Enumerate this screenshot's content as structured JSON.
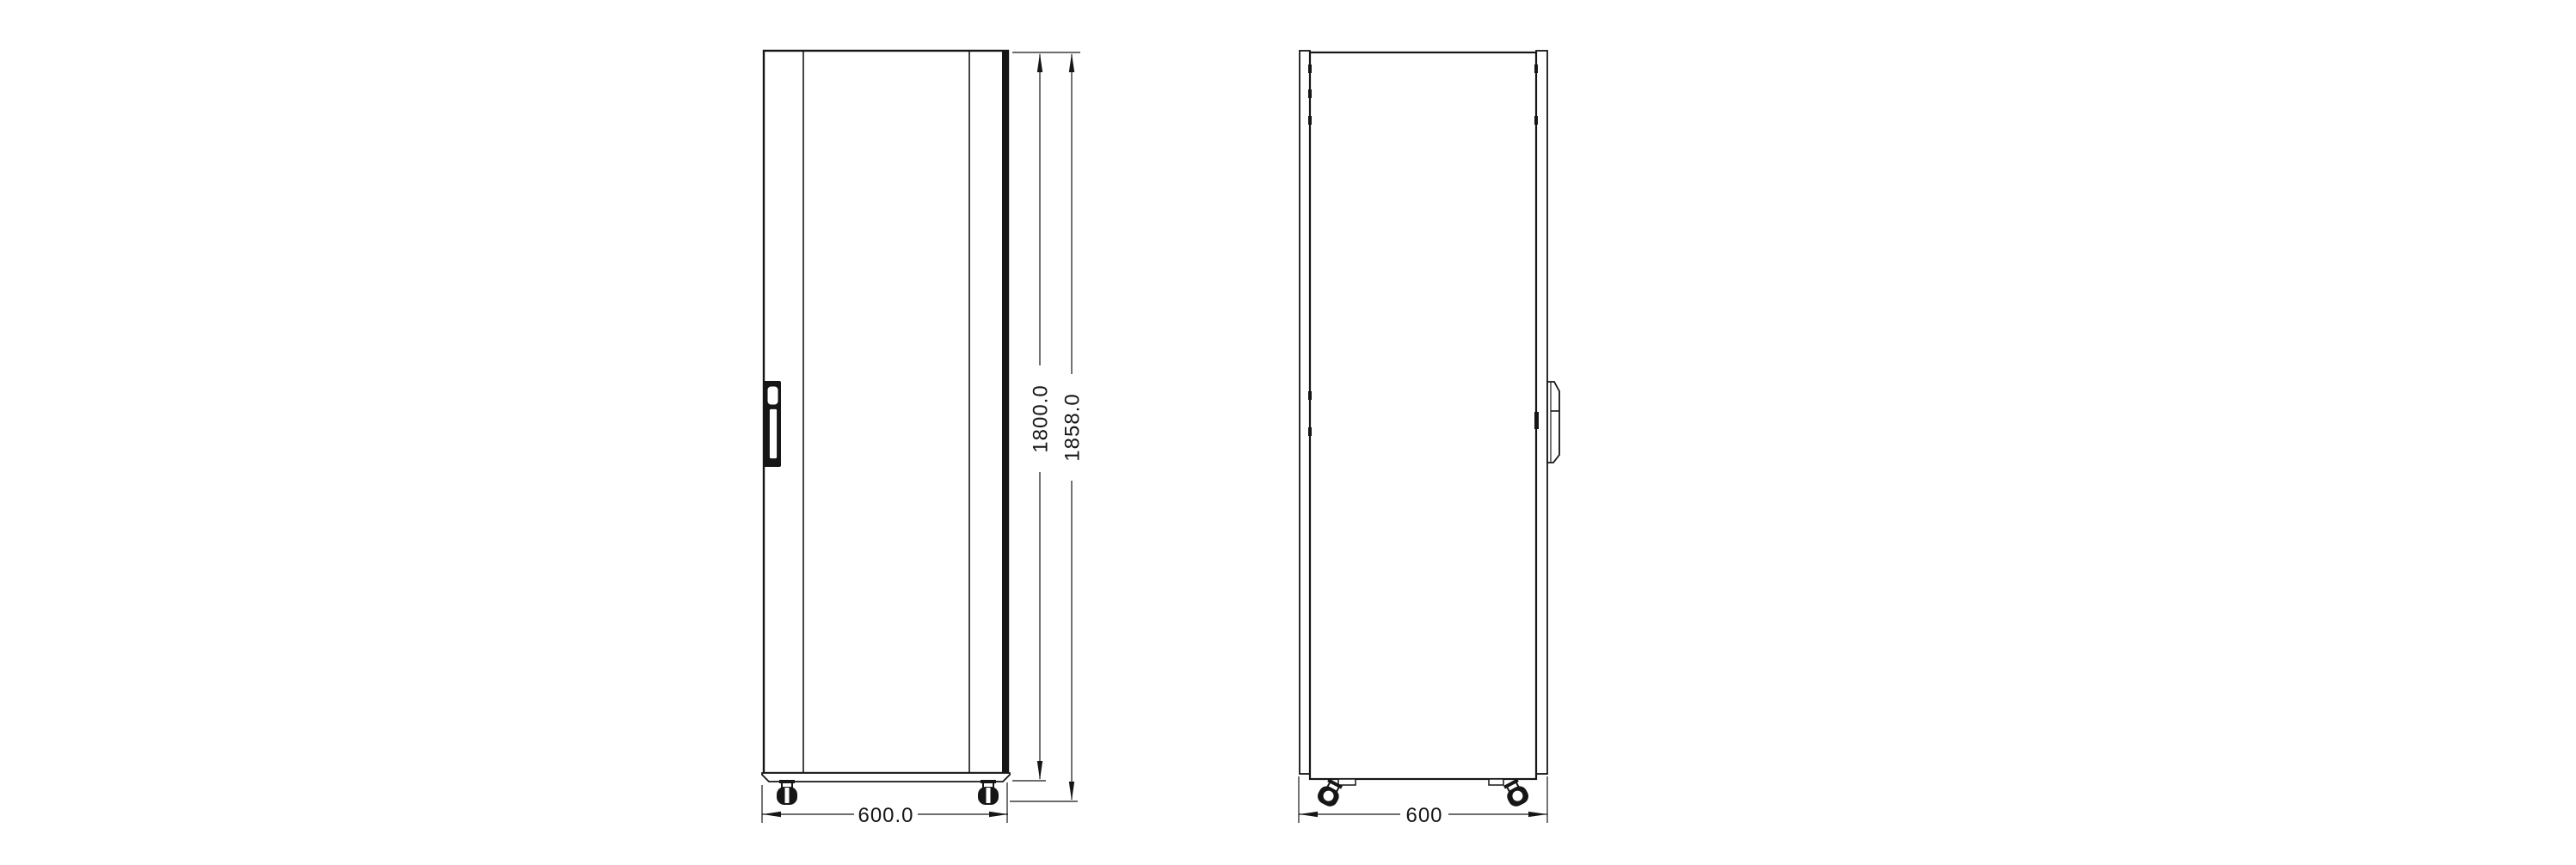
{
  "drawing": {
    "colors": {
      "background": "#ffffff",
      "line": "#161616"
    },
    "views": {
      "front": {
        "dimensions": {
          "width": "600.0",
          "body_height": "1800.0",
          "total_height": "1858.0"
        }
      },
      "side": {
        "dimensions": {
          "depth": "600"
        }
      }
    }
  }
}
